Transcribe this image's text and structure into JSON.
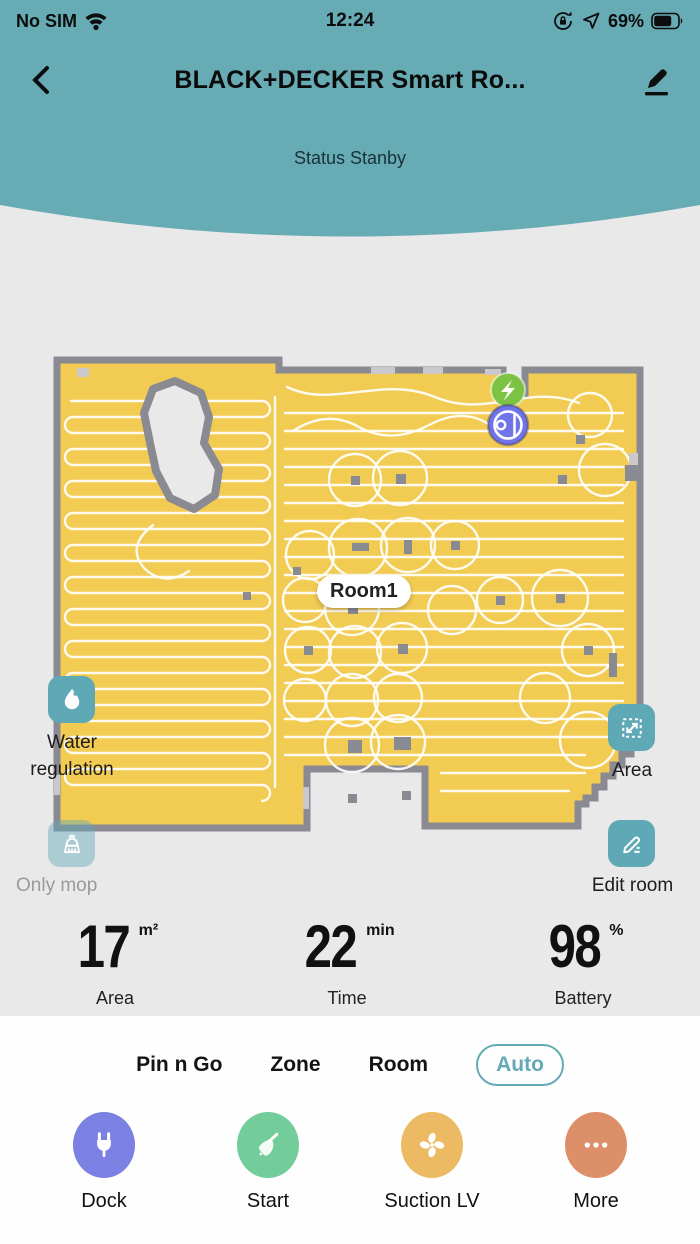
{
  "status_bar": {
    "carrier": "No SIM",
    "time": "12:24",
    "battery_percent": "69%"
  },
  "header": {
    "title": "BLACK+DECKER Smart Ro...",
    "status_text": "Status Stanby"
  },
  "map": {
    "room_label": "Room1"
  },
  "map_controls": {
    "water_regulation_label": "Water regulation",
    "only_mop_label": "Only mop",
    "area_label": "Area",
    "edit_room_label": "Edit room"
  },
  "stats": {
    "area": {
      "value": "17",
      "unit": "m²",
      "label": "Area"
    },
    "time": {
      "value": "22",
      "unit": "min",
      "label": "Time"
    },
    "battery": {
      "value": "98",
      "unit": "%",
      "label": "Battery"
    }
  },
  "modes": {
    "items": [
      {
        "label": "Pin n Go",
        "selected": false
      },
      {
        "label": "Zone",
        "selected": false
      },
      {
        "label": "Room",
        "selected": false
      },
      {
        "label": "Auto",
        "selected": true
      }
    ]
  },
  "actions": {
    "dock": {
      "label": "Dock",
      "color": "#7b80e3"
    },
    "start": {
      "label": "Start",
      "color": "#72cd9b"
    },
    "suction": {
      "label": "Suction LV",
      "color": "#ecba62"
    },
    "more": {
      "label": "More",
      "color": "#dd8f69"
    }
  },
  "colors": {
    "header_teal": "#67abb4",
    "background": "#e9e9e9",
    "map_floor": "#f2cb52",
    "map_wall": "#8a8a92",
    "accent_teal": "#5fa9b6",
    "dock_green": "#7dc343",
    "robot_blue": "#6f74e8"
  }
}
